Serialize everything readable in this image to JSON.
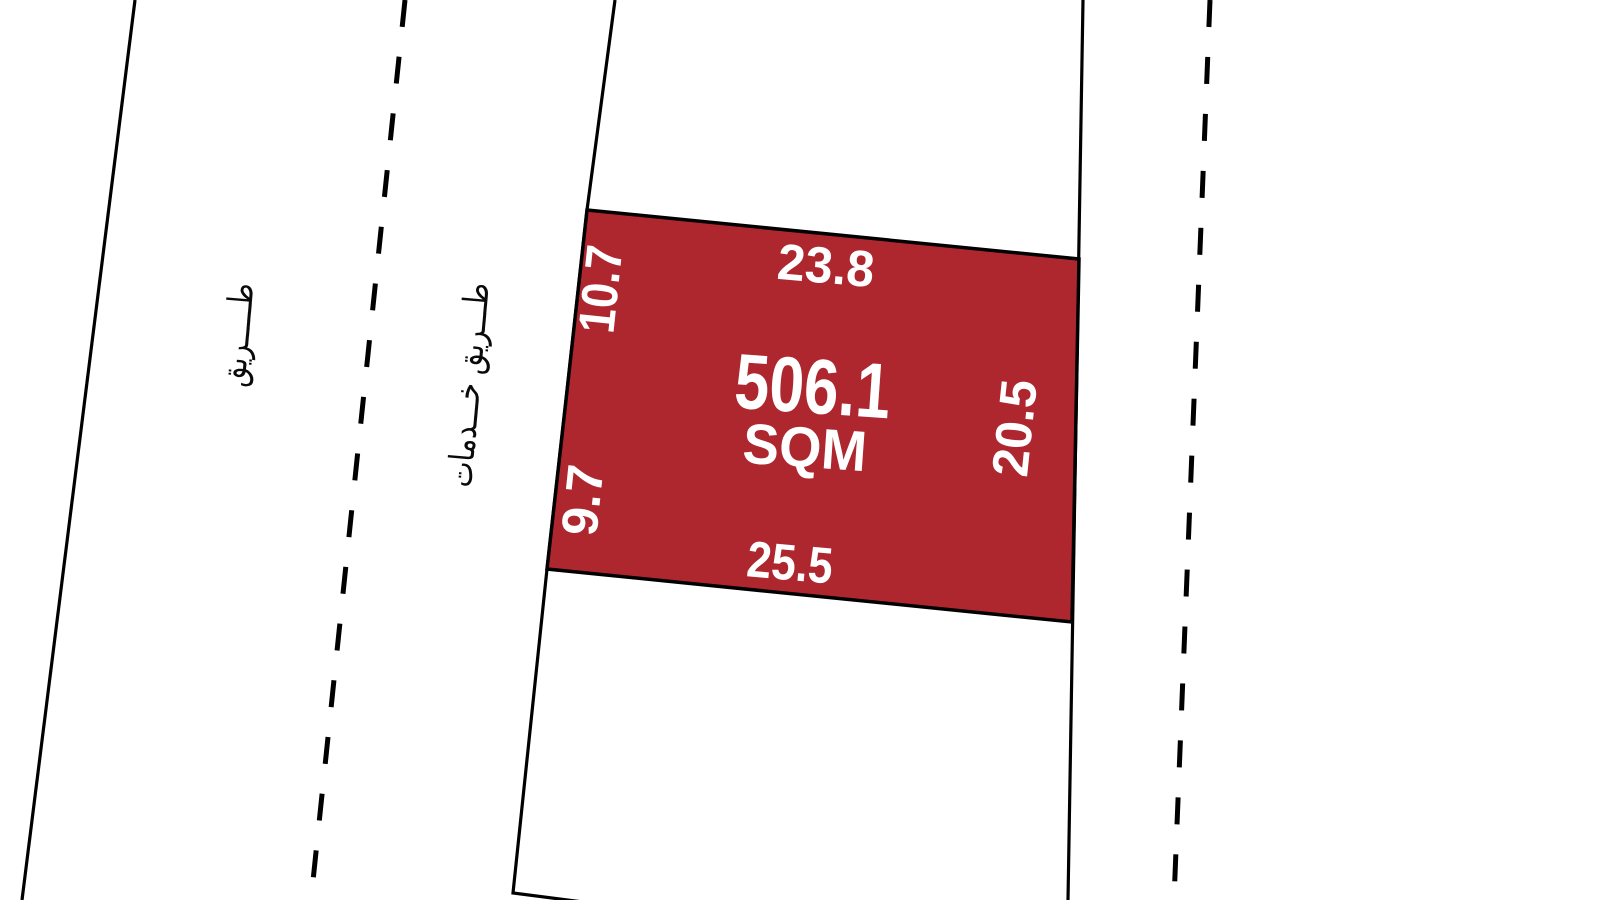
{
  "map": {
    "plot": {
      "area_value": "506.1",
      "area_unit": "SQM",
      "dimensions": {
        "top": "23.8",
        "right": "20.5",
        "bottom": "25.5",
        "left_upper": "10.7",
        "left_lower": "9.7"
      }
    },
    "roads": {
      "left_road_label": "طـــــريق",
      "service_road_label": "طـــريق خـــدمات"
    },
    "colors": {
      "parcel_fill": "#AE272F",
      "boundary_line": "#000000",
      "parcel_text": "#FFFFFF",
      "road_text": "#0A0A0A",
      "background": "#FFFFFF"
    }
  }
}
